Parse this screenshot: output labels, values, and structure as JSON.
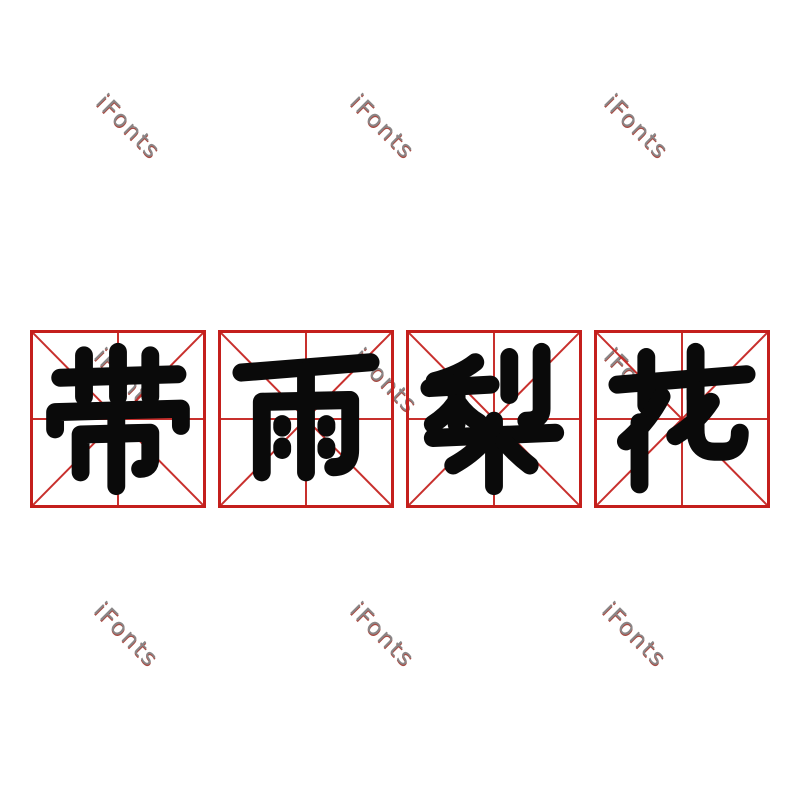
{
  "phrase": {
    "text": "带雨梨花"
  },
  "characters": [
    {
      "char": "带"
    },
    {
      "char": "雨"
    },
    {
      "char": "梨"
    },
    {
      "char": "花"
    }
  ],
  "watermark": {
    "text": "iFonts"
  },
  "colors": {
    "background": "#ffffff",
    "glyph_black": "#0a0a0a",
    "grid_red": "#c41f1c",
    "watermark_gray": "#8a8687",
    "watermark_shadow": "#a84a42"
  }
}
